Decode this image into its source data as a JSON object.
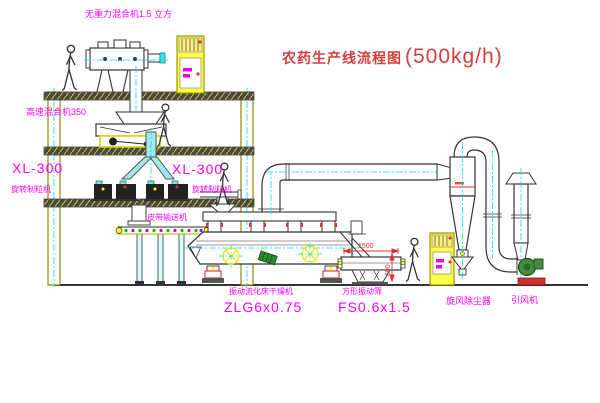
{
  "title": {
    "name": "农药生产线流程图",
    "capacity": "(500kg/h)"
  },
  "equipment": {
    "gravity_mixer": {
      "label": "无重力混合机1.5 立方"
    },
    "high_speed_mixer": {
      "label": "高速混合机350"
    },
    "granulator_left": {
      "model": "XL-300",
      "name": "旋转制粒机"
    },
    "granulator_right": {
      "model": "XL-300",
      "name": "旋转制粒机"
    },
    "belt_conveyor": {
      "name": "皮带输送机"
    },
    "fluid_bed_dryer": {
      "name": "振动流化床干燥机",
      "model": "ZLG6x0.75"
    },
    "square_sieve": {
      "name": "方形振动筛",
      "model": "FS0.6x1.5"
    },
    "cyclone": {
      "name": "旋风除尘器"
    },
    "induced_draft_fan": {
      "name": "引风机"
    }
  },
  "dimensions": {
    "sieve_length": "1500",
    "sieve_height": "600"
  },
  "colors": {
    "label_magenta": "#ff00ff",
    "title_red": "#d04040",
    "dimension_red": "#e03030",
    "centerline_cyan": "#00e5e5",
    "cad_yellow": "#ffff00",
    "structure_olive": "#8b8b00",
    "line_dark": "#333333",
    "motor_green": "#2d8a2d"
  }
}
